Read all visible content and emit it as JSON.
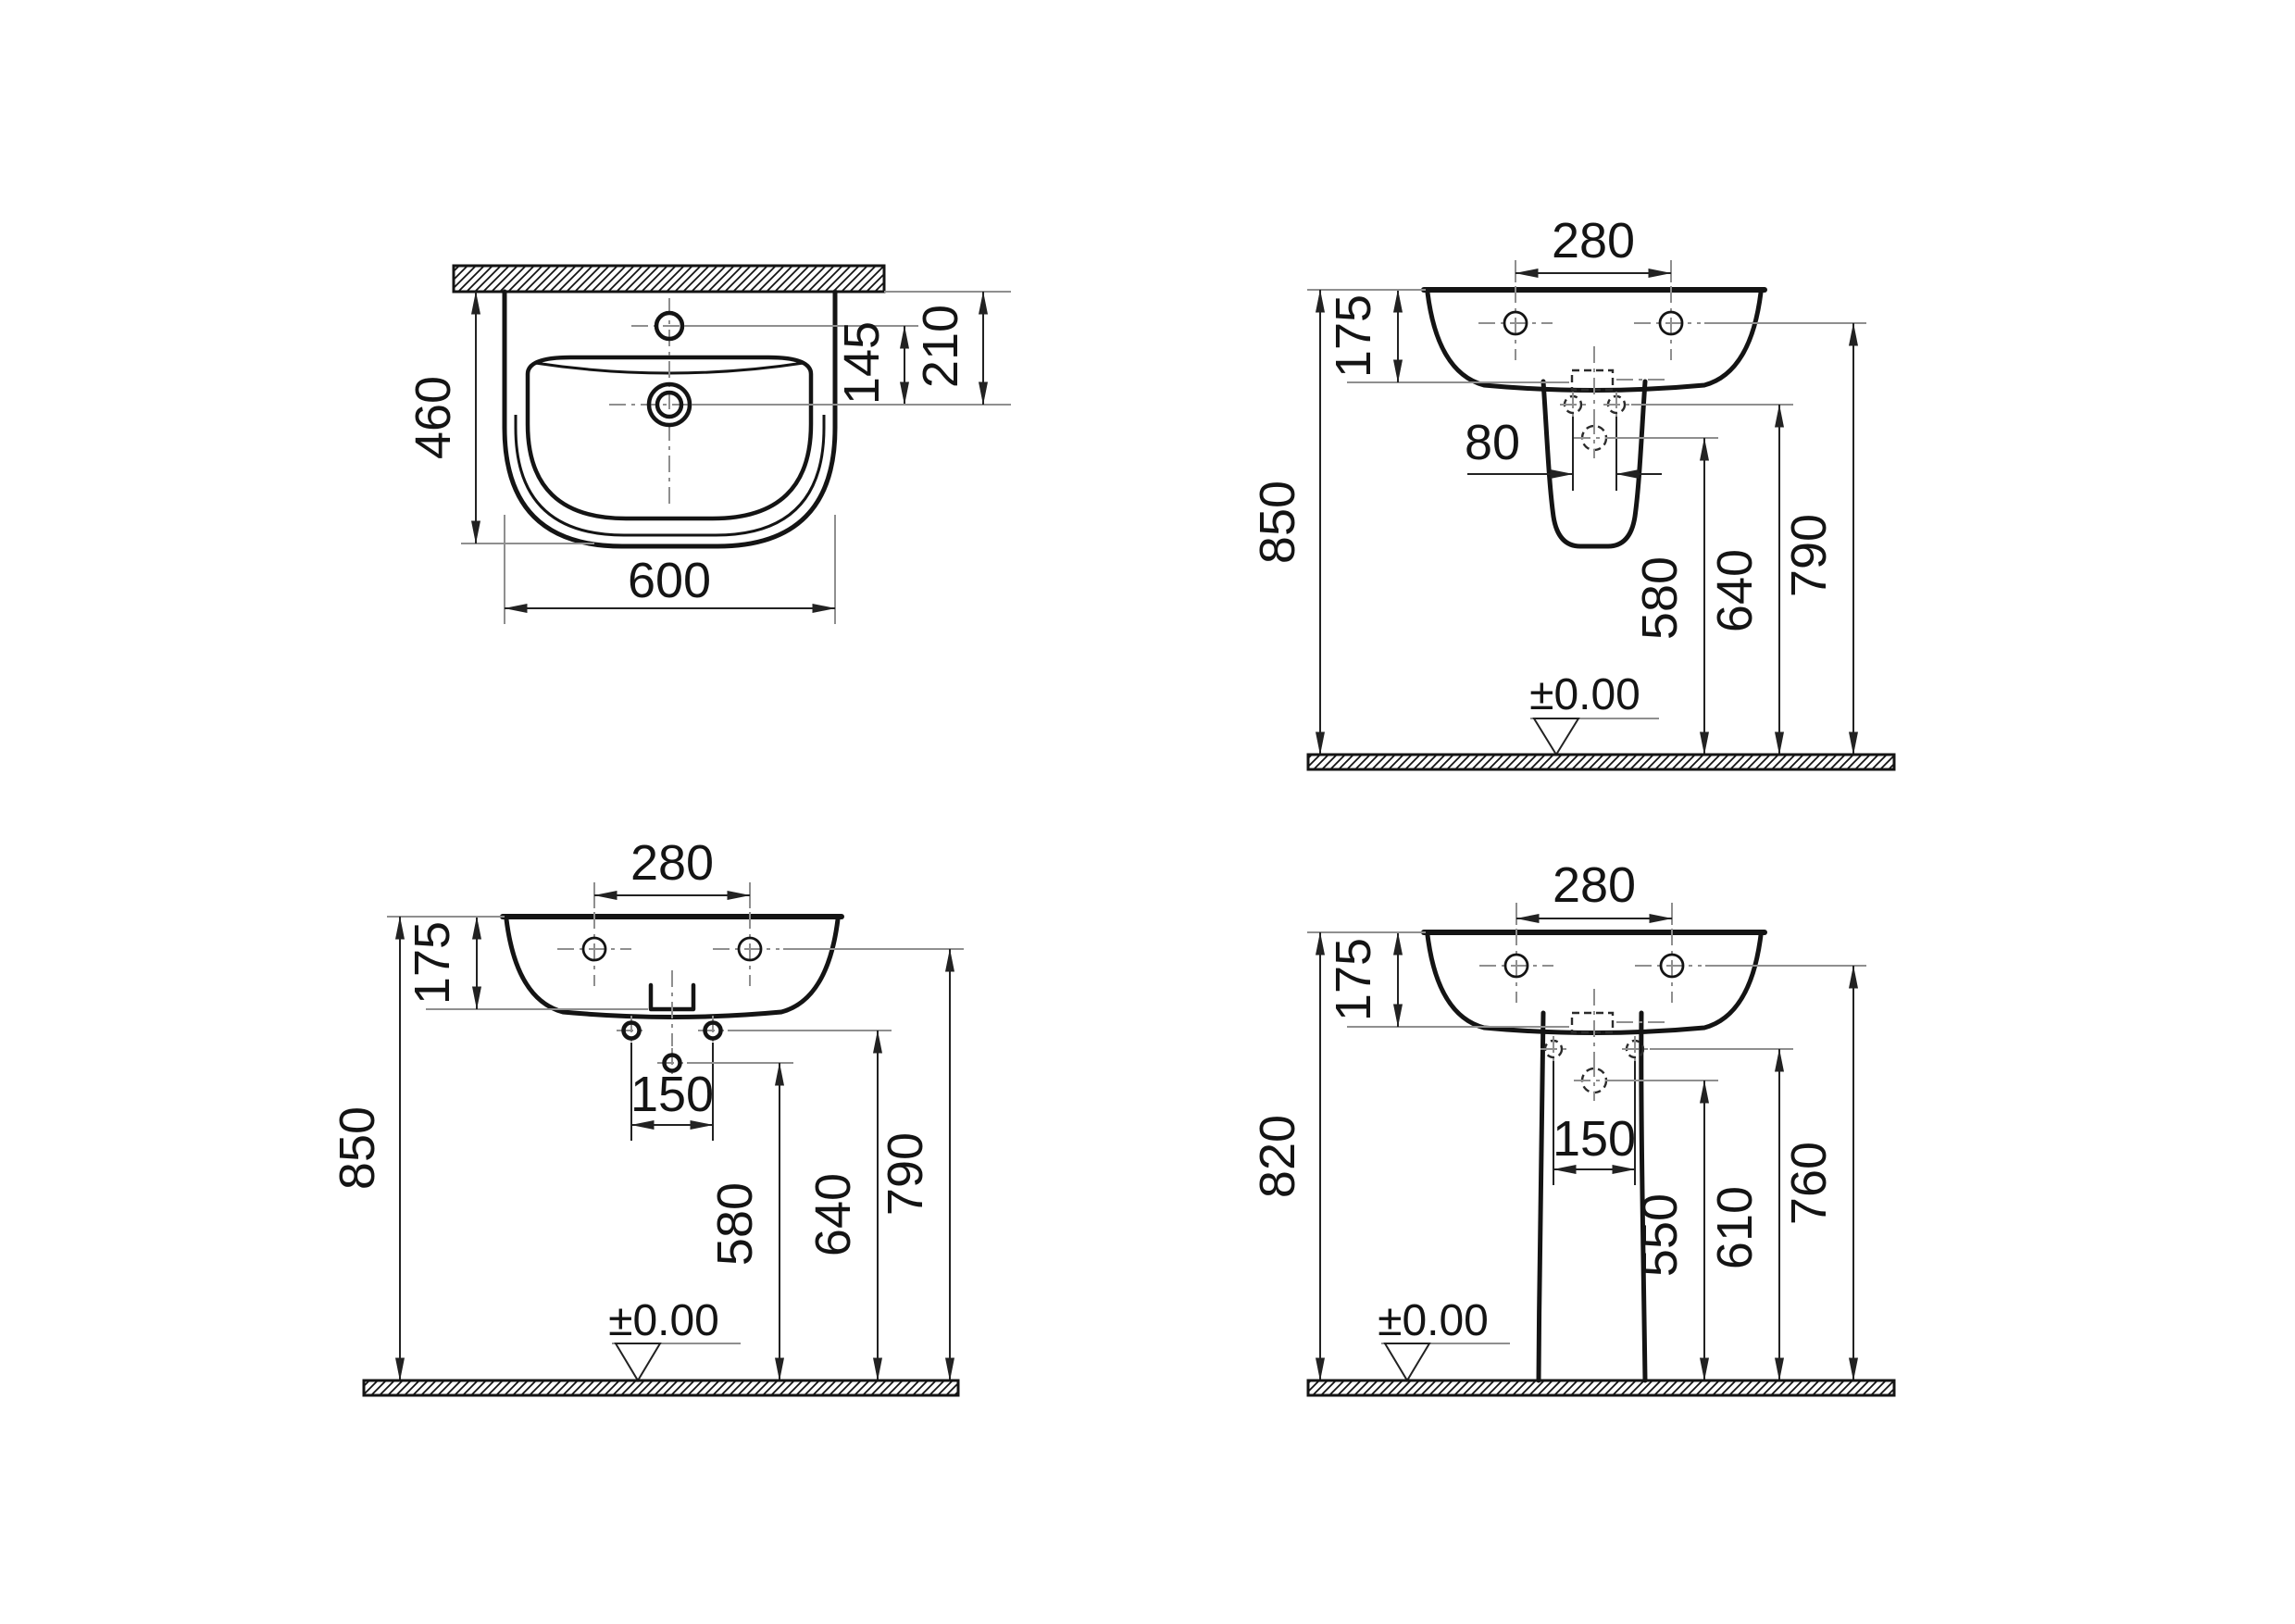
{
  "drawing": {
    "type": "washbasin-technical-drawing",
    "background": "#ffffff",
    "line_color": "#141414",
    "extension_line_color": "#8f8f8f",
    "views": {
      "plan": {
        "dims": {
          "depth": "460",
          "width": "600",
          "tap_to_drain": "145",
          "wall_to_drain": "210"
        }
      },
      "semi_pedestal": {
        "dims": {
          "hole_spacing": "280",
          "basin_height": "175",
          "total_height": "850",
          "bolt_spacing": "80",
          "trap_height": "580",
          "bolt_height": "640",
          "fixing_height": "790",
          "floor_level": "±0.00"
        }
      },
      "wall_hung": {
        "dims": {
          "hole_spacing": "280",
          "basin_height": "175",
          "total_height": "850",
          "bolt_spacing": "150",
          "trap_height": "580",
          "bolt_height": "640",
          "fixing_height": "790",
          "floor_level": "±0.00"
        }
      },
      "pedestal": {
        "dims": {
          "hole_spacing": "280",
          "basin_height": "175",
          "total_height": "820",
          "bolt_spacing": "150",
          "trap_height": "550",
          "bolt_height": "610",
          "fixing_height": "760",
          "floor_level": "±0.00"
        }
      }
    }
  }
}
